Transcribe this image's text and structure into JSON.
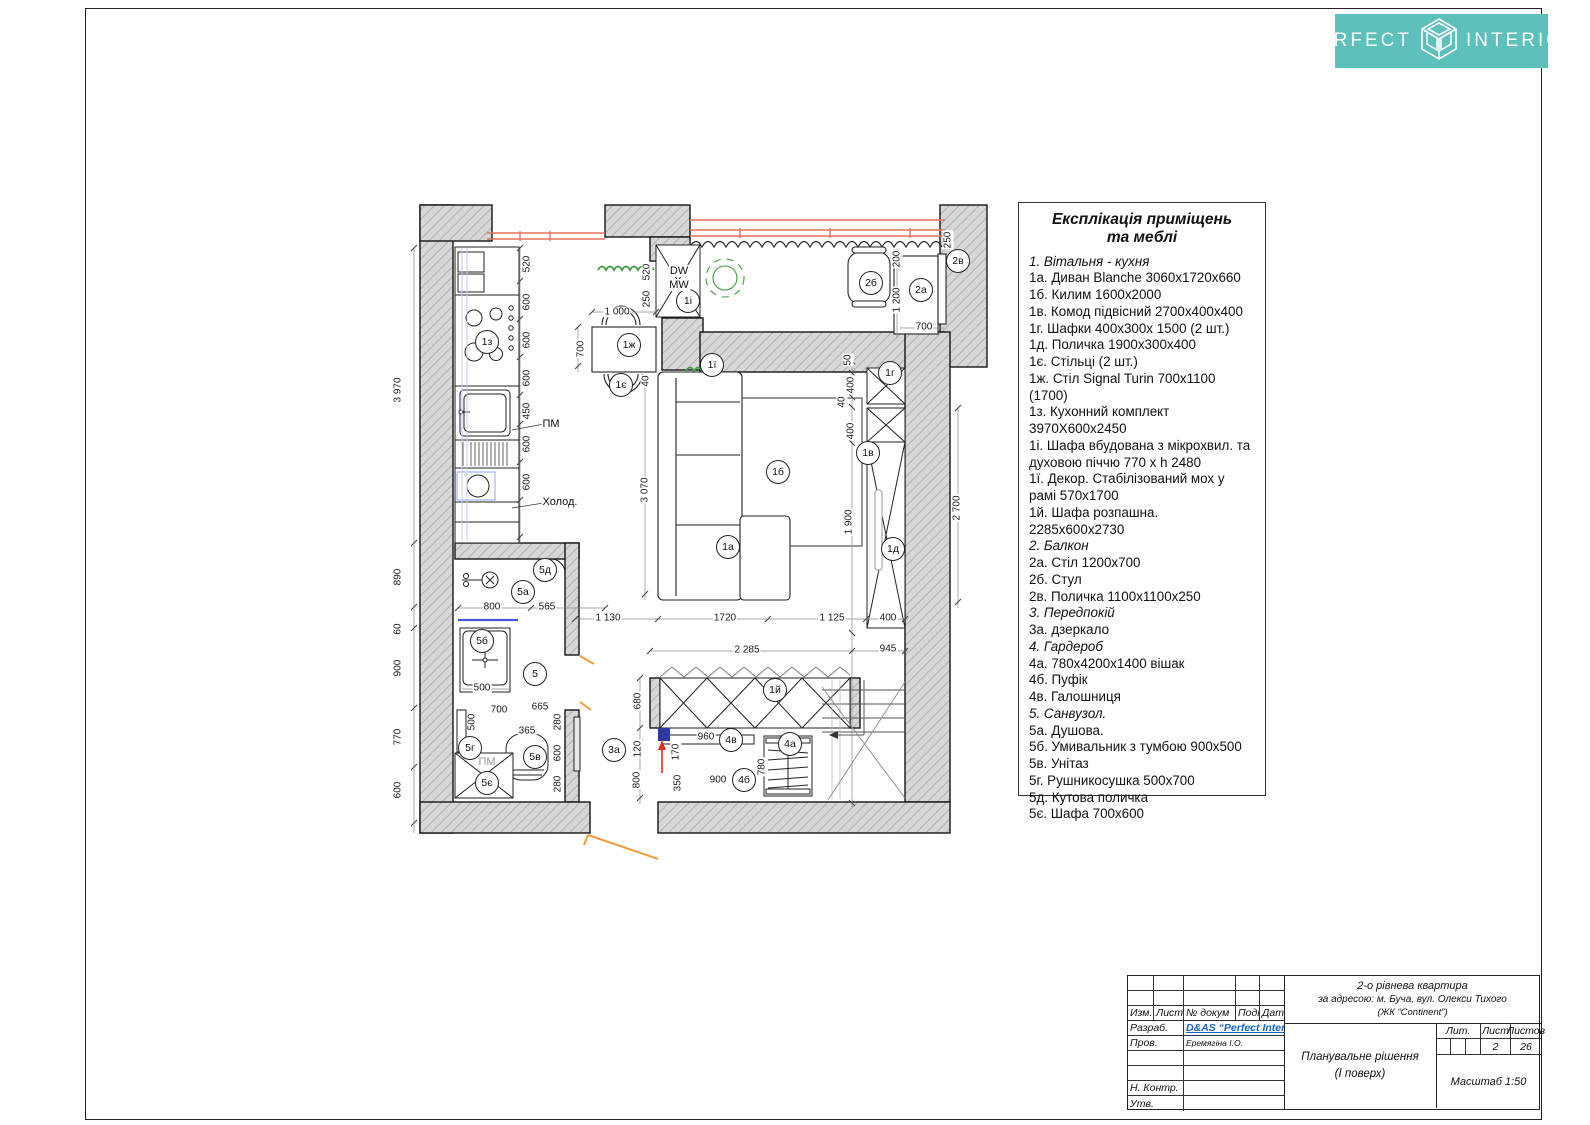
{
  "logo": {
    "left": "PERFECT",
    "right": "INTERIOR"
  },
  "colors": {
    "accent_teal": "#5cc0bb",
    "window_red": "#e4705f",
    "door_orange": "#f59a3c",
    "decor_green": "#3f9e3f",
    "entry_blue": "#2d3ba0",
    "link_blue": "#1464c8"
  },
  "legend": {
    "title_line1": "Експлікація приміщень",
    "title_line2": "та меблі",
    "items": [
      {
        "t": "1. Вітальня - кухня",
        "i": true
      },
      {
        "t": "1а. Диван Blanche 3060х1720х660"
      },
      {
        "t": "1б. Килим 1600х2000"
      },
      {
        "t": "1в. Комод підвісний 2700х400х400"
      },
      {
        "t": "1г. Шафки  400х300х 1500 (2 шт.)"
      },
      {
        "t": "1д. Поличка 1900х300х400"
      },
      {
        "t": "1є. Стільці (2 шт.)"
      },
      {
        "t": "1ж. Стіл  Signal Turin 700х1100 (1700)"
      },
      {
        "t": "1з. Кухонний комплект 3970Х600х2450"
      },
      {
        "t": "1і. Шафа  вбудована з мікрохвил. та духовою піччю 770 х h 2480"
      },
      {
        "t": "1ї. Декор. Стабілізований мох у рамі 570х1700"
      },
      {
        "t": "1й.  Шафа розпашна. 2285х600х2730"
      },
      {
        "t": "2. Балкон",
        "i": true
      },
      {
        "t": "2а. Стіл 1200х700"
      },
      {
        "t": "2б. Стул"
      },
      {
        "t": "2в. Поличка 1100х1100х250"
      },
      {
        "t": "3. Передпокій",
        "i": true
      },
      {
        "t": "3а. дзеркало"
      },
      {
        "t": "4. Гардероб",
        "i": true
      },
      {
        "t": "4а. 780х4200х1400 вішак"
      },
      {
        "t": "4б. Пуфік"
      },
      {
        "t": "4в. Галошниця"
      },
      {
        "t": "5. Санвузол.",
        "i": true
      },
      {
        "t": "5а.  Душова."
      },
      {
        "t": "5б. Умивальник  з тумбою 900х500"
      },
      {
        "t": "5в. Унітаз"
      },
      {
        "t": "5г. Рушникосушка 500х700"
      },
      {
        "t": "5д. Кутова поличка"
      },
      {
        "t": "5є. Шафа 700х600"
      }
    ]
  },
  "plan": {
    "dims": [
      {
        "t": "3 970",
        "x": 398,
        "y": 390,
        "v": 1
      },
      {
        "t": "890",
        "x": 398,
        "y": 577,
        "v": 1
      },
      {
        "t": "60",
        "x": 398,
        "y": 629,
        "v": 1
      },
      {
        "t": "900",
        "x": 398,
        "y": 668,
        "v": 1
      },
      {
        "t": "770",
        "x": 398,
        "y": 737,
        "v": 1
      },
      {
        "t": "600",
        "x": 398,
        "y": 790,
        "v": 1
      },
      {
        "t": "520",
        "x": 527,
        "y": 264,
        "v": 1
      },
      {
        "t": "600",
        "x": 527,
        "y": 302,
        "v": 1
      },
      {
        "t": "600",
        "x": 527,
        "y": 340,
        "v": 1
      },
      {
        "t": "600",
        "x": 527,
        "y": 378,
        "v": 1
      },
      {
        "t": "450",
        "x": 527,
        "y": 411,
        "v": 1
      },
      {
        "t": "600",
        "x": 527,
        "y": 444,
        "v": 1
      },
      {
        "t": "600",
        "x": 527,
        "y": 482,
        "v": 1
      },
      {
        "t": "1 000",
        "x": 617,
        "y": 312,
        "v": 0
      },
      {
        "t": "700",
        "x": 581,
        "y": 349,
        "v": 1
      },
      {
        "t": "40",
        "x": 646,
        "y": 381,
        "v": 1
      },
      {
        "t": "520",
        "x": 647,
        "y": 272,
        "v": 1
      },
      {
        "t": "250",
        "x": 647,
        "y": 299,
        "v": 1
      },
      {
        "t": "250",
        "x": 948,
        "y": 240,
        "v": 1
      },
      {
        "t": "200",
        "x": 897,
        "y": 259,
        "v": 1
      },
      {
        "t": "1 200",
        "x": 897,
        "y": 300,
        "v": 1
      },
      {
        "t": "700",
        "x": 924,
        "y": 327,
        "v": 0
      },
      {
        "t": "50",
        "x": 848,
        "y": 360,
        "v": 1
      },
      {
        "t": "400",
        "x": 851,
        "y": 385,
        "v": 1
      },
      {
        "t": "40",
        "x": 842,
        "y": 402,
        "v": 1
      },
      {
        "t": "400",
        "x": 851,
        "y": 431,
        "v": 1
      },
      {
        "t": "1 900",
        "x": 849,
        "y": 522,
        "v": 1
      },
      {
        "t": "2 700",
        "x": 957,
        "y": 508,
        "v": 1
      },
      {
        "t": "3 070",
        "x": 645,
        "y": 490,
        "v": 1
      },
      {
        "t": "800",
        "x": 492,
        "y": 607,
        "v": 0
      },
      {
        "t": "565",
        "x": 547,
        "y": 607,
        "v": 0
      },
      {
        "t": "1 130",
        "x": 608,
        "y": 618,
        "v": 0
      },
      {
        "t": "1720",
        "x": 725,
        "y": 618,
        "v": 0
      },
      {
        "t": "1 125",
        "x": 832,
        "y": 618,
        "v": 0
      },
      {
        "t": "400",
        "x": 888,
        "y": 618,
        "v": 0
      },
      {
        "t": "500",
        "x": 482,
        "y": 688,
        "v": 0
      },
      {
        "t": "700",
        "x": 499,
        "y": 710,
        "v": 0
      },
      {
        "t": "500",
        "x": 472,
        "y": 722,
        "v": 1
      },
      {
        "t": "665",
        "x": 540,
        "y": 707,
        "v": 0
      },
      {
        "t": "365",
        "x": 527,
        "y": 731,
        "v": 0
      },
      {
        "t": "280",
        "x": 558,
        "y": 722,
        "v": 1
      },
      {
        "t": "600",
        "x": 558,
        "y": 753,
        "v": 1
      },
      {
        "t": "280",
        "x": 558,
        "y": 784,
        "v": 1
      },
      {
        "t": "2 285",
        "x": 747,
        "y": 650,
        "v": 0
      },
      {
        "t": "945",
        "x": 888,
        "y": 649,
        "v": 0
      },
      {
        "t": "680",
        "x": 638,
        "y": 701,
        "v": 1
      },
      {
        "t": "120",
        "x": 638,
        "y": 749,
        "v": 1
      },
      {
        "t": "800",
        "x": 637,
        "y": 780,
        "v": 1
      },
      {
        "t": "170",
        "x": 676,
        "y": 752,
        "v": 1
      },
      {
        "t": "960",
        "x": 706,
        "y": 737,
        "v": 0
      },
      {
        "t": "780",
        "x": 762,
        "y": 767,
        "v": 1
      },
      {
        "t": "900",
        "x": 718,
        "y": 780,
        "v": 0
      },
      {
        "t": "350",
        "x": 678,
        "y": 783,
        "v": 1
      }
    ],
    "tags": [
      {
        "t": "1з",
        "x": 487,
        "y": 342
      },
      {
        "t": "1ж",
        "x": 629,
        "y": 345
      },
      {
        "t": "1є",
        "x": 621,
        "y": 385
      },
      {
        "t": "1і",
        "x": 688,
        "y": 301
      },
      {
        "t": "1ї",
        "x": 712,
        "y": 365
      },
      {
        "t": "1а",
        "x": 728,
        "y": 547
      },
      {
        "t": "1б",
        "x": 778,
        "y": 472
      },
      {
        "t": "1г",
        "x": 890,
        "y": 373
      },
      {
        "t": "1в",
        "x": 868,
        "y": 453
      },
      {
        "t": "1д",
        "x": 893,
        "y": 549
      },
      {
        "t": "2б",
        "x": 871,
        "y": 283
      },
      {
        "t": "2а",
        "x": 921,
        "y": 290
      },
      {
        "t": "2в",
        "x": 958,
        "y": 261
      },
      {
        "t": "5д",
        "x": 545,
        "y": 570
      },
      {
        "t": "5а",
        "x": 523,
        "y": 592
      },
      {
        "t": "5б",
        "x": 482,
        "y": 641
      },
      {
        "t": "5",
        "x": 535,
        "y": 674
      },
      {
        "t": "5г",
        "x": 470,
        "y": 748
      },
      {
        "t": "5в",
        "x": 535,
        "y": 757
      },
      {
        "t": "5є",
        "x": 487,
        "y": 783
      },
      {
        "t": "3а",
        "x": 614,
        "y": 750
      },
      {
        "t": "1й",
        "x": 775,
        "y": 690
      },
      {
        "t": "4в",
        "x": 731,
        "y": 740
      },
      {
        "t": "4а",
        "x": 790,
        "y": 744
      },
      {
        "t": "4б",
        "x": 744,
        "y": 780
      }
    ],
    "notes": [
      {
        "t": "ПМ",
        "x": 551,
        "y": 424
      },
      {
        "t": "Холод.",
        "x": 560,
        "y": 502
      },
      {
        "t": "DW",
        "x": 679,
        "y": 271
      },
      {
        "t": "MW",
        "x": 679,
        "y": 285
      },
      {
        "t": "ПМ",
        "x": 487,
        "y": 762,
        "m": 1
      }
    ]
  },
  "titleblock": {
    "cols": [
      "Изм.",
      "Лист",
      "№ докум",
      "Подп.",
      "Дата"
    ],
    "dev_label": "Разраб.",
    "dev_value": "D&AS “Perfect Interior”",
    "check_label": "Пров.",
    "check_value": "Еремягіна І.О.",
    "ncontrol_label": "Н. Контр.",
    "approve_label": "Утв.",
    "project_line1": "2-о рівнева квартира",
    "project_line2": "за адресою: м. Буча, вул. Олекси Тихого",
    "project_line3": "(ЖК “Continent”)",
    "doc_line1": "Планувальне рішення",
    "doc_line2": "(І поверх)",
    "lit_label": "Лит.",
    "sheet_label": "Лист",
    "sheets_label": "Листов",
    "sheet_value": "2",
    "sheets_value": "26",
    "scale": "Масштаб 1:50"
  }
}
